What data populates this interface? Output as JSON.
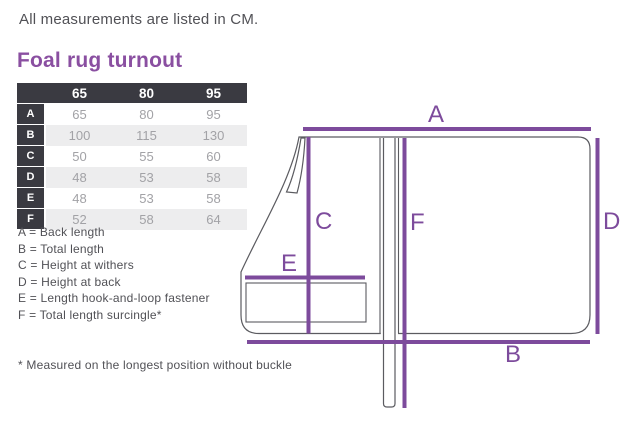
{
  "page": {
    "unit_note": "All measurements are listed in CM.",
    "title": "Foal rug turnout",
    "footnote": "* Measured on the longest position without buckle"
  },
  "size_table": {
    "column_headers": [
      "65",
      "80",
      "95"
    ],
    "rows": [
      {
        "label": "A",
        "values": [
          "65",
          "80",
          "95"
        ]
      },
      {
        "label": "B",
        "values": [
          "100",
          "115",
          "130"
        ]
      },
      {
        "label": "C",
        "values": [
          "50",
          "55",
          "60"
        ]
      },
      {
        "label": "D",
        "values": [
          "48",
          "53",
          "58"
        ]
      },
      {
        "label": "E",
        "values": [
          "48",
          "53",
          "58"
        ]
      },
      {
        "label": "F",
        "values": [
          "52",
          "58",
          "64"
        ]
      }
    ]
  },
  "legend": {
    "items": [
      "A = Back length",
      "B = Total length",
      "C = Height at withers",
      "D = Height at back",
      "E = Length hook-and-loop fastener",
      "F = Total length surcingle*"
    ]
  },
  "diagram": {
    "labels": {
      "a": "A",
      "b": "B",
      "c": "C",
      "d": "D",
      "e": "E",
      "f": "F"
    }
  },
  "colors": {
    "accent_purple": "#7d4b9c",
    "title_purple": "#8a4fa1",
    "table_header_bg": "#3a3a41",
    "table_alt_row_bg": "#ededee",
    "table_value_text": "#a2a2a6",
    "body_text": "#515156",
    "diagram_outline": "#5b5b60"
  }
}
